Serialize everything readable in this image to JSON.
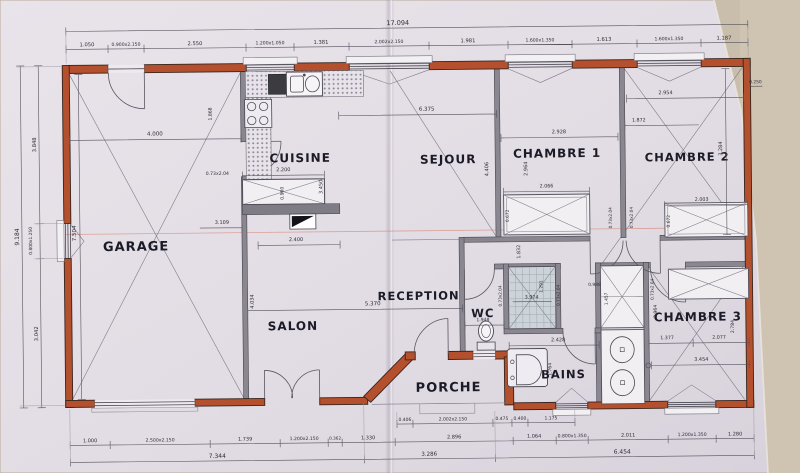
{
  "plan_title": "Plan de maison (rez-de-chaussée)",
  "colors": {
    "paper": "#e4dee6",
    "photo_background": "#c9bdab",
    "exterior_wall": "#b4502d",
    "interior_wall": "#8a8791",
    "section_line": "#d4836f",
    "shower_tile": "#ccd3d9",
    "label_text": "#1b1b28"
  },
  "rooms": {
    "garage": "GARAGE",
    "cuisine": "CUISINE",
    "sejour": "SEJOUR",
    "chambre1": "CHAMBRE 1",
    "chambre2": "CHAMBRE 2",
    "chambre3": "CHAMBRE 3",
    "salon": "SALON",
    "reception": "RECEPTION",
    "wc": "WC",
    "bains": "BAINS",
    "porche": "PORCHE"
  },
  "dims": {
    "top_total": "17.094",
    "top": [
      "1.050",
      "0.900x2.150",
      "2.550",
      "1.200x1.050",
      "1.381",
      "2.002x2.150",
      "1.981",
      "1.600x1.350",
      "1.613",
      "1.600x1.350",
      "1.187"
    ],
    "bottom_inner": [
      "0.406",
      "2.002x2.150",
      "0.475",
      "0.400",
      "1.175"
    ],
    "bottom_left": [
      "1.000",
      "2.500x2.150",
      "1.739",
      "1.200x2.150",
      "0.362",
      "1.330"
    ],
    "bottom_right": [
      "2.896",
      "1.064",
      "0.800x1.350",
      "2.011",
      "1.200x1.350",
      "1.280"
    ],
    "bottom_total_left": "7.344",
    "bottom_total_mid": "3.286",
    "bottom_total_right": "6.454",
    "left": {
      "upper": "3.848",
      "total": "9.184",
      "window": "0.800x1.250",
      "lower": "3.042"
    },
    "right": {
      "wall": "0.250",
      "depth": "3.284"
    },
    "garage": {
      "width": "4.000",
      "height": "7.504",
      "door": "0.73x2.04",
      "inner": "3.109"
    },
    "cuisine": {
      "counter": "1.868",
      "island_w": "2.200",
      "island_d": "0.960",
      "clear": "2.400",
      "depth": "3.450"
    },
    "sejour": {
      "width": "6.375",
      "depth": "4.406"
    },
    "chambre1": {
      "width": "2.928",
      "depth": "2.964",
      "wardrobe_w": "2.066",
      "wardrobe_d": "0.672",
      "door": "0.73x2.04"
    },
    "chambre2": {
      "width": "2.954",
      "wall": "1.872",
      "wardrobe_w": "2.003",
      "wardrobe_d": "0.672",
      "door": "0.73x2.04"
    },
    "chambre3": {
      "a": "1.377",
      "b": "2.077",
      "depth_l": "2.964",
      "depth_r": "2.784",
      "width": "3.454",
      "door": "0.73x2.04"
    },
    "salon": {
      "width": "5.370",
      "depth": "4.034"
    },
    "hall": {
      "width": "1.832"
    },
    "wc": {
      "width": "1.948",
      "door": "0.73x2.04"
    },
    "shower": {
      "w": "3.974",
      "h": "1.291",
      "door": "0.73x2.04"
    },
    "bains": {
      "width": "2.428",
      "tub": "1.764",
      "closet_w": "0.988",
      "closet_h": "1.457"
    }
  }
}
